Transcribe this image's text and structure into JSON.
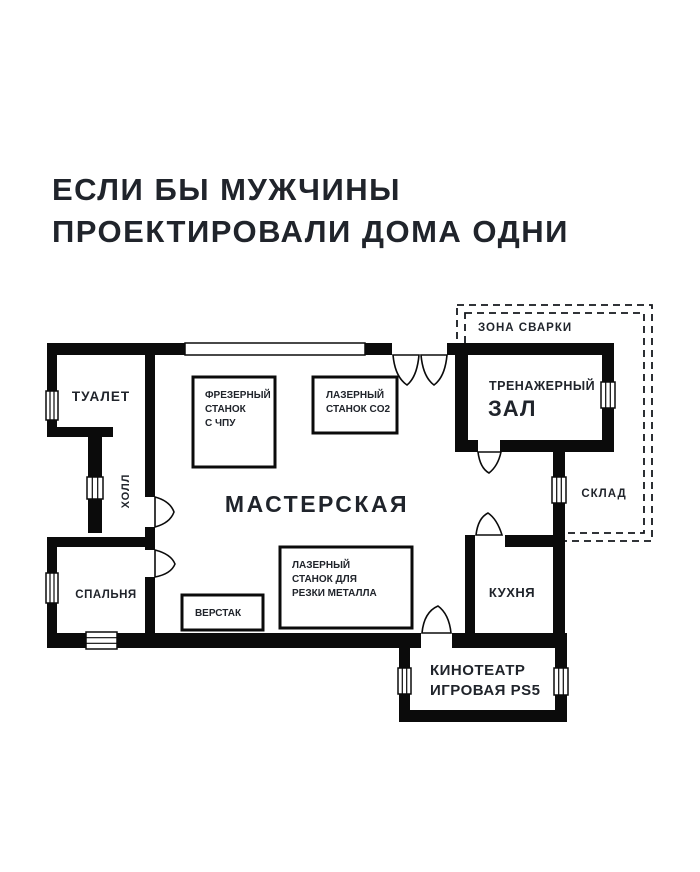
{
  "title": {
    "line1": "ЕСЛИ БЫ МУЖЧИНЫ",
    "line2": "ПРОЕКТИРОВАЛИ ДОМА ОДНИ"
  },
  "colors": {
    "background": "#ffffff",
    "walls": "#0b0b0b",
    "text": "#20242b"
  },
  "floor_plan": {
    "rooms": {
      "toilet": {
        "label": "ТУАЛЕТ"
      },
      "hall": {
        "label": "ХОЛЛ"
      },
      "bedroom": {
        "label": "СПАЛЬНЯ"
      },
      "workshop": {
        "label": "МАСТЕРСКАЯ"
      },
      "gym": {
        "line1": "ТРЕНАЖЕРНЫЙ",
        "line2": "ЗАЛ"
      },
      "storage": {
        "label": "СКЛАД"
      },
      "kitchen": {
        "label": "КУХНЯ"
      },
      "cinema": {
        "line1": "КИНОТЕАТР",
        "line2": "ИГРОВАЯ PS5"
      },
      "welding_zone": {
        "label": "ЗОНА СВАРКИ"
      }
    },
    "equipment": {
      "cnc_mill": {
        "line1": "ФРЕЗЕРНЫЙ",
        "line2": "СТАНОК",
        "line3": "С ЧПУ"
      },
      "laser_co2": {
        "line1": "ЛАЗЕРНЫЙ",
        "line2": "СТАНОК CO2"
      },
      "laser_metal": {
        "line1": "ЛАЗЕРНЫЙ",
        "line2": "СТАНОК ДЛЯ",
        "line3": "РЕЗКИ МЕТАЛЛА"
      },
      "workbench": {
        "label": "ВЕРСТАК"
      }
    }
  }
}
